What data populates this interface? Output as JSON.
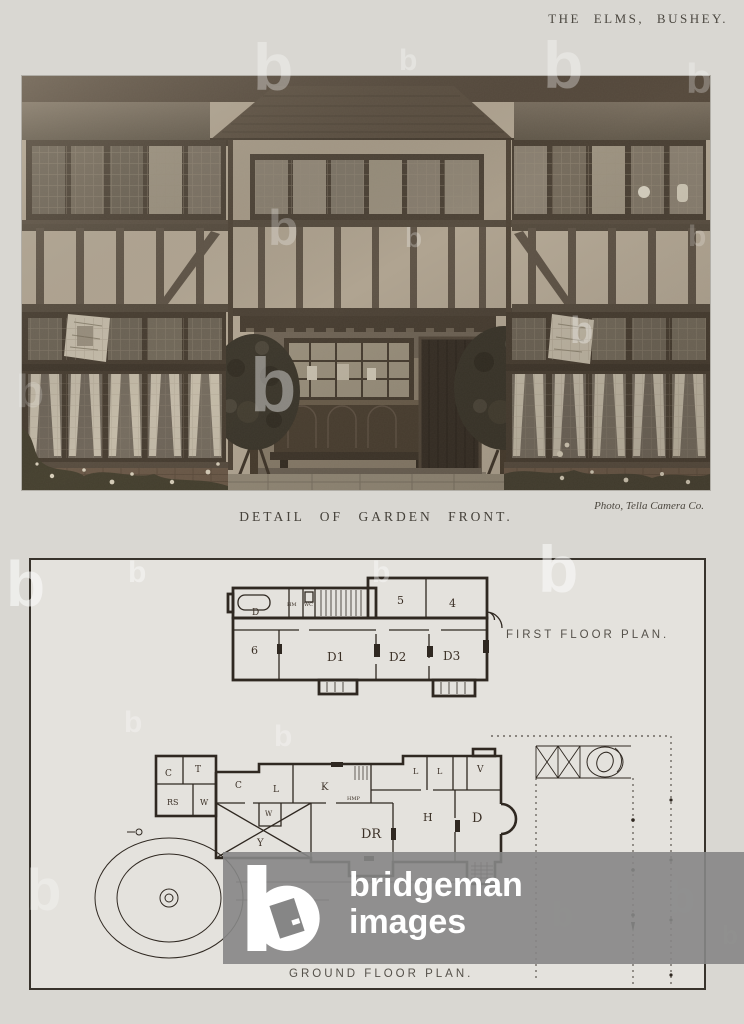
{
  "page": {
    "header": "THE ELMS, BUSHEY.",
    "photo_caption": "DETAIL OF GARDEN FRONT.",
    "photo_credit": "Photo, Tella Camera Co."
  },
  "plans": {
    "first_floor": {
      "title": "FIRST FLOOR PLAN.",
      "rooms": [
        {
          "label": "D"
        },
        {
          "label": "HM"
        },
        {
          "label": "WC"
        },
        {
          "label": "6"
        },
        {
          "label": "5"
        },
        {
          "label": "4"
        },
        {
          "label": "D1"
        },
        {
          "label": "D2"
        },
        {
          "label": "D3"
        }
      ]
    },
    "ground_floor": {
      "title": "GROUND FLOOR PLAN.",
      "rooms": [
        {
          "label": "C"
        },
        {
          "label": "T"
        },
        {
          "label": "RS"
        },
        {
          "label": "W"
        },
        {
          "label": "C"
        },
        {
          "label": "L"
        },
        {
          "label": "W"
        },
        {
          "label": "K"
        },
        {
          "label": "HMP"
        },
        {
          "label": "Y"
        },
        {
          "label": "DR"
        },
        {
          "label": "L"
        },
        {
          "label": "L"
        },
        {
          "label": "V"
        },
        {
          "label": "H"
        },
        {
          "label": "D"
        }
      ]
    }
  },
  "watermark": {
    "letter": "b",
    "brand_line1": "bridgeman",
    "brand_line2": "images",
    "band_color": "#868686"
  },
  "colors": {
    "page_background": "#d9d7d2",
    "plan_background": "#e4e2dd",
    "plan_ink": "#2f2821",
    "photo_sepia_stucco": "#b3a794",
    "photo_sepia_timber": "#5e5346",
    "watermark_band": "#868686"
  }
}
